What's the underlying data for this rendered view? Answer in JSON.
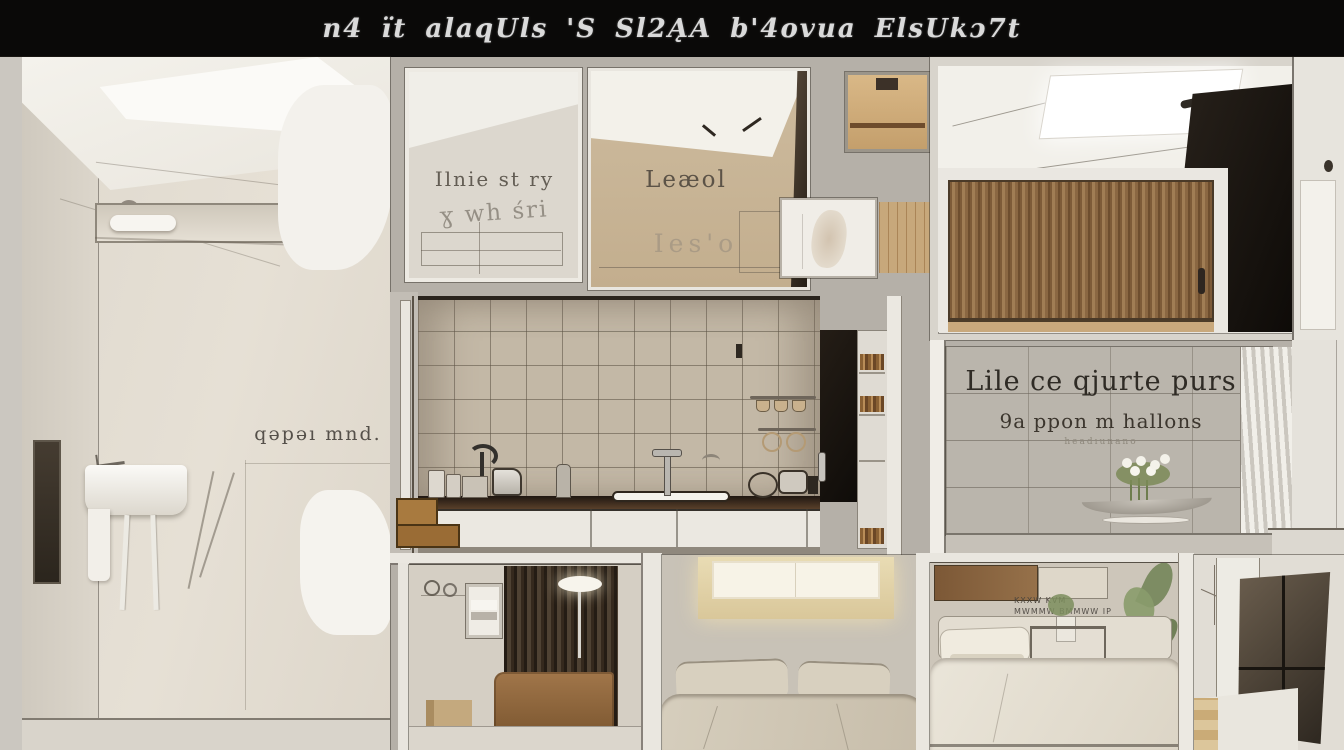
{
  "title_bar": {
    "text": "n4 ït alaqUls 'S Sl2ĄA b'4ovua ElsUkɔ7t",
    "background": "#0a0908",
    "text_color": "#ececec"
  },
  "palette": {
    "wall_greige": "#b5b0a8",
    "wall_cream": "#e3ddd2",
    "kitchen_tile_beige": "#c3b8a6",
    "alcove_tile_gray": "#bab5ac",
    "wood_light": "#a07d54",
    "wood_slat_dark": "#4f4233",
    "black_cabinet": "#17120d",
    "warm_glow": "#f3e6c2",
    "bed_linen": "#d8d0bf"
  },
  "rooms": {
    "bathroom": {
      "wall_text": "qəpəı mnd."
    },
    "sketch_room_left": {
      "wall_text_line1": "Ilnie st ry",
      "wall_text_line2": "ɣ wh śri"
    },
    "sketch_room_right": {
      "wall_text_line1": "Leæol",
      "wall_text_line2": "Ies'o"
    },
    "tiled_alcove": {
      "wall_text_line1": "Lile ce qjurte purs",
      "wall_text_line2": "9a ppon m hallons",
      "wall_text_line3": "headıunano"
    },
    "bedroom_right": {
      "wall_marks_line1": "KXXW  KVM",
      "wall_marks_line2": "MWMMW BMMWW IP"
    }
  }
}
